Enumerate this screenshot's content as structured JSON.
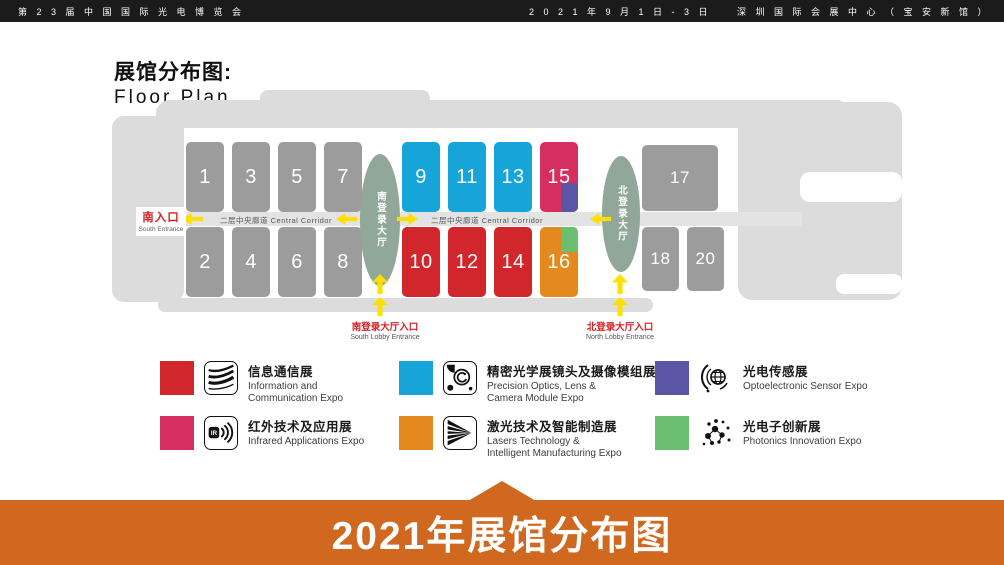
{
  "header": {
    "expo_name": "第 2 3 届 中 国 国 际 光 电 博 览 会",
    "dates": "2 0 2 1 年 9 月 1 日 - 3 日",
    "venue": "深 圳 国 际 会 展 中 心 （ 宝 安 新 馆 ）"
  },
  "plan": {
    "title_zh": "展馆分布图:",
    "title_en": "Floor Plan",
    "corridor_label": "二层中央廊道 Central Corridor",
    "south_entrance": {
      "zh": "南入口",
      "en": "South Entrance"
    },
    "south_lobby": {
      "hall_zh": "南登录大厅",
      "entrance_zh": "南登录大厅入口",
      "entrance_en": "South Lobby Entrance"
    },
    "north_lobby": {
      "hall_zh": "北登录大厅",
      "entrance_zh": "北登录大厅入口",
      "entrance_en": "North Lobby Entrance"
    },
    "halls": [
      {
        "num": "1",
        "type": "general"
      },
      {
        "num": "3",
        "type": "general"
      },
      {
        "num": "5",
        "type": "general"
      },
      {
        "num": "7",
        "type": "general"
      },
      {
        "num": "2",
        "type": "general"
      },
      {
        "num": "4",
        "type": "general"
      },
      {
        "num": "6",
        "type": "general"
      },
      {
        "num": "8",
        "type": "general"
      },
      {
        "num": "9",
        "type": "optics"
      },
      {
        "num": "11",
        "type": "optics"
      },
      {
        "num": "13",
        "type": "optics"
      },
      {
        "num": "15",
        "type": "infrared",
        "corner": {
          "type": "sensor",
          "anchor": "bottom-right"
        }
      },
      {
        "num": "10",
        "type": "info"
      },
      {
        "num": "12",
        "type": "info"
      },
      {
        "num": "14",
        "type": "info"
      },
      {
        "num": "16",
        "type": "laser",
        "corner": {
          "type": "photonics",
          "anchor": "top-right"
        }
      },
      {
        "num": "17",
        "type": "general"
      },
      {
        "num": "18",
        "type": "general"
      },
      {
        "num": "20",
        "type": "general"
      }
    ]
  },
  "colors": {
    "info": "#d1262b",
    "optics": "#17a5d9",
    "infrared": "#d72e60",
    "sensor": "#5b55a5",
    "laser": "#e4891d",
    "photonics": "#6cbe71",
    "general": "#9c9c9c",
    "outline": "#dcdcdc",
    "corridor": "#e3e3e3",
    "lobby_oval": "#90a79a",
    "arrow_yellow": "#ffdf00",
    "entrance_red": "#d42025",
    "footer_orange": "#d0681f",
    "topbar_black": "#1b1b1b"
  },
  "legend": {
    "items": [
      {
        "zh": "信息通信展",
        "en": "Information and\nCommunication Expo",
        "color": "#d1262b",
        "icon": "fiber-lines-icon"
      },
      {
        "zh": "精密光学展镜头及摄像模组展",
        "en": "Precision Optics, Lens &\nCamera Module Expo",
        "color": "#17a5d9",
        "icon": "camera-lens-icon"
      },
      {
        "zh": "光电传感展",
        "en": "Optoelectronic Sensor Expo",
        "color": "#5b55a5",
        "icon": "sensor-globe-icon"
      },
      {
        "zh": "红外技术及应用展",
        "en": "Infrared Applications Expo",
        "color": "#d72e60",
        "icon": "infrared-waves-icon"
      },
      {
        "zh": "激光技术及智能制造展",
        "en": "Lasers Technology &\nIntelligent Manufacturing Expo",
        "color": "#e4891d",
        "icon": "laser-beams-icon"
      },
      {
        "zh": "光电子创新展",
        "en": "Photonics Innovation Expo",
        "color": "#6cbe71",
        "icon": "photonics-network-icon"
      }
    ]
  },
  "footer": {
    "title": "2021年展馆分布图"
  }
}
